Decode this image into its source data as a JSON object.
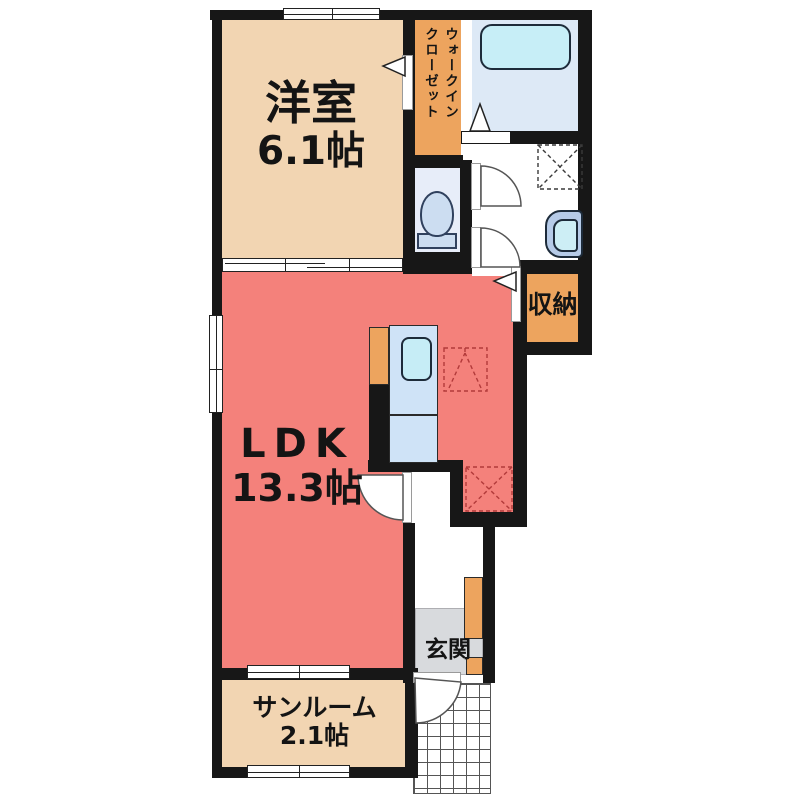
{
  "plan": {
    "rooms": {
      "western": {
        "label": "洋室",
        "size": "6.1帖"
      },
      "ldk": {
        "label": "LDK",
        "size": "13.3帖"
      },
      "sunroom": {
        "label": "サンルーム",
        "size": "2.1帖"
      },
      "wic": {
        "line1": "ウォークイン",
        "line2": "クローゼット"
      },
      "storage": {
        "label": "収納"
      },
      "entrance": {
        "label": "玄関"
      }
    },
    "colors": {
      "wall": "#171717",
      "tan_room": "#f2d5b2",
      "ldk_red": "#f4817b",
      "closet_orange": "#eda45e",
      "bath_floor": "#dde9f6",
      "toilet_floor": "#e7edf9",
      "fixture_blue": "#c7eef7",
      "counter_blue": "#cfe3f7",
      "genkan_gray": "#d8dadd",
      "symbol_red_dash": "#b23a3a"
    }
  }
}
